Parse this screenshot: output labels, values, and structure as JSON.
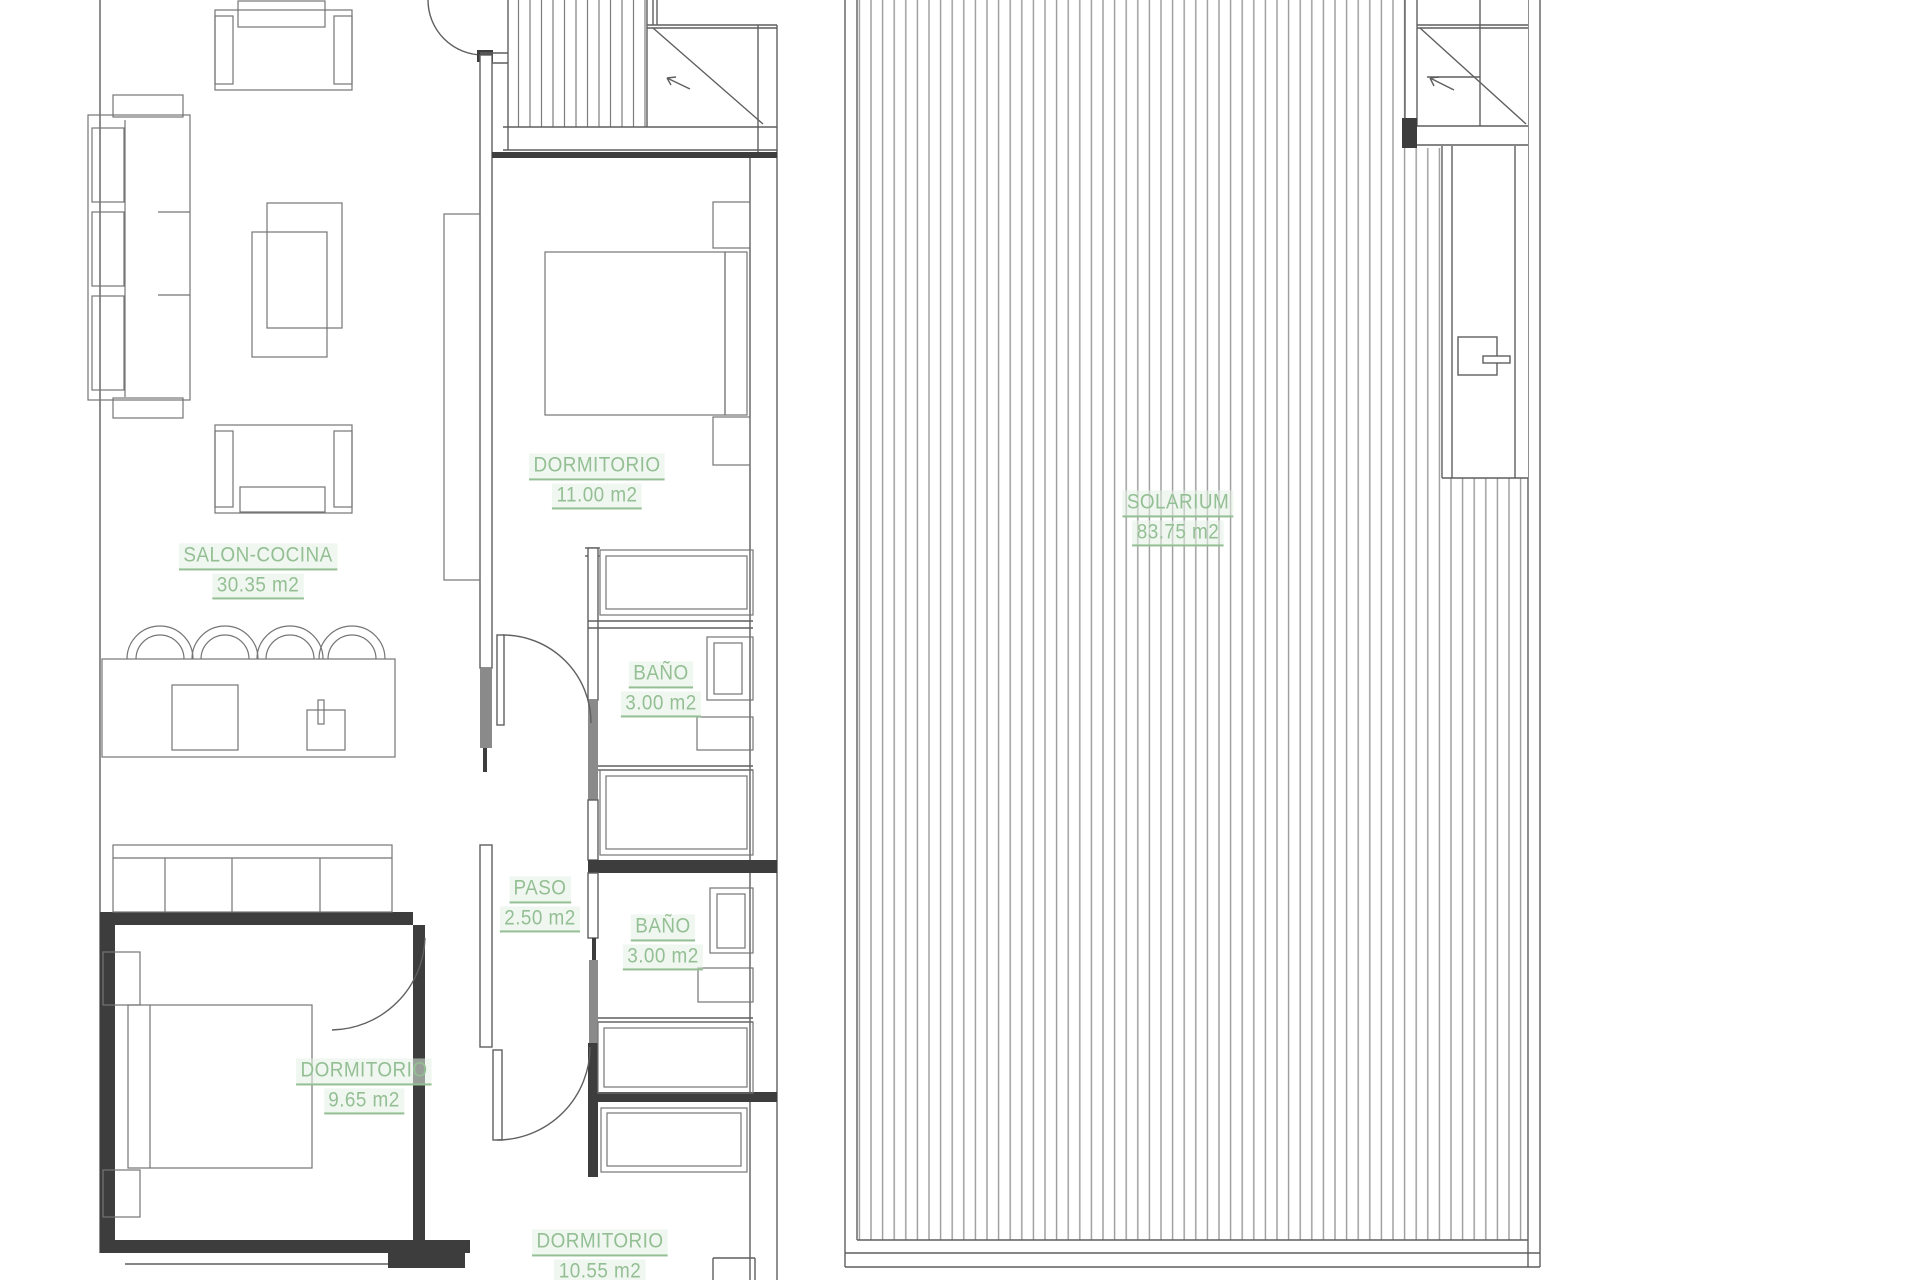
{
  "document": {
    "type": "architectural-floor-plan",
    "language": "es"
  },
  "colors": {
    "background": "#ffffff",
    "label_green": "#94bf94",
    "wall_dark": "#3d3d3d",
    "line_gray": "#5f5f5f",
    "hatch_gray": "#9a9a9a"
  },
  "rooms": [
    {
      "id": "salon-cocina",
      "name": "SALON-COCINA",
      "area": "30.35 m2",
      "x": 258,
      "y": 570
    },
    {
      "id": "dormitorio-1",
      "name": "DORMITORIO",
      "area": "11.00 m2",
      "x": 597,
      "y": 480
    },
    {
      "id": "bano-1",
      "name": "BAÑO",
      "area": "3.00 m2",
      "x": 661,
      "y": 688
    },
    {
      "id": "paso",
      "name": "PASO",
      "area": "2.50 m2",
      "x": 540,
      "y": 903
    },
    {
      "id": "bano-2",
      "name": "BAÑO",
      "area": "3.00 m2",
      "x": 663,
      "y": 941
    },
    {
      "id": "dormitorio-2",
      "name": "DORMITORIO",
      "area": "9.65 m2",
      "x": 364,
      "y": 1085
    },
    {
      "id": "dormitorio-3",
      "name": "DORMITORIO",
      "area": "10.55 m2",
      "x": 600,
      "y": 1256
    },
    {
      "id": "solarium",
      "name": "SOLARIUM",
      "area": "83.75 m2",
      "x": 1178,
      "y": 517
    }
  ]
}
